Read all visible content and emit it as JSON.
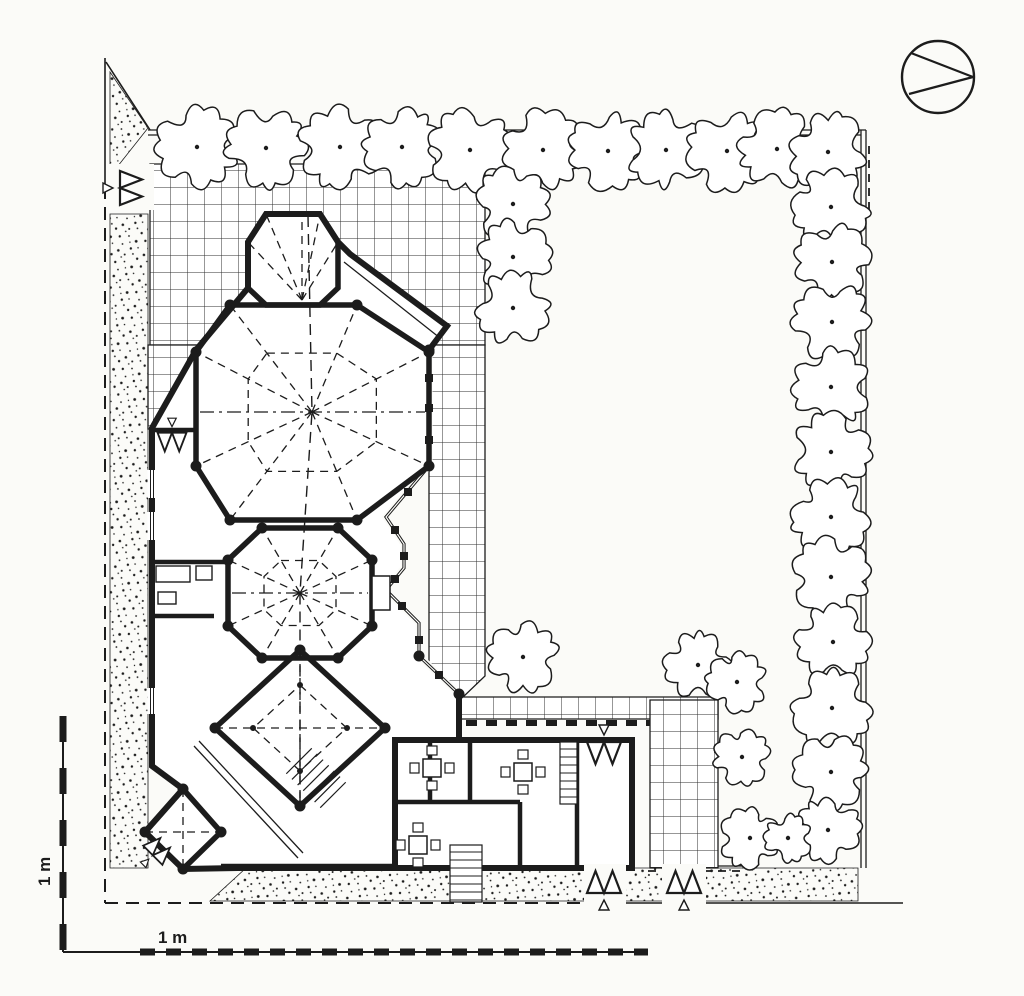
{
  "meta": {
    "drawing_type": "architectural site plan",
    "paper_color": "#fbfbf8",
    "ink_color": "#1c1c1c",
    "grid_line_color": "#2f2f2f"
  },
  "scale_bars": {
    "vertical_label": "1 m",
    "horizontal_label": "1 m",
    "vertical_line": [
      63,
      716,
      63,
      952
    ],
    "horizontal_line": [
      63,
      952,
      648,
      952
    ],
    "horizontal_dashes": [
      140,
      952,
      648,
      952
    ]
  },
  "north_arrow": {
    "cx": 938,
    "cy": 77,
    "r": 36,
    "chords": [
      [
        911,
        53,
        973,
        77
      ],
      [
        909,
        94,
        973,
        77
      ]
    ]
  },
  "boundary": {
    "solid": [
      [
        105,
        58,
        105,
        186
      ],
      [
        585,
        903,
        903,
        903
      ],
      [
        106,
        62,
        150,
        130
      ]
    ],
    "dashed": [
      [
        105,
        186,
        105,
        903
      ],
      [
        105,
        903,
        585,
        903
      ]
    ]
  },
  "fence": {
    "lines": [
      [
        148,
        130,
        866,
        130
      ],
      [
        148,
        135,
        861,
        135
      ],
      [
        861,
        130,
        861,
        868
      ],
      [
        866,
        130,
        866,
        868
      ],
      [
        650,
        866,
        746,
        866
      ]
    ],
    "dashed": [
      [
        869,
        146,
        869,
        214
      ],
      [
        744,
        810,
        744,
        866
      ],
      [
        648,
        871,
        746,
        871
      ]
    ]
  },
  "stipple_areas": [
    [
      [
        110,
        72
      ],
      [
        148,
        128
      ],
      [
        110,
        176
      ]
    ],
    [
      [
        110,
        214
      ],
      [
        148,
        214
      ],
      [
        148,
        868
      ],
      [
        110,
        868
      ]
    ],
    [
      [
        246,
        868
      ],
      [
        858,
        868
      ],
      [
        858,
        901
      ],
      [
        210,
        901
      ]
    ]
  ],
  "paving": {
    "cell": 17,
    "areas": [
      [
        [
          150,
          164
        ],
        [
          485,
          164
        ],
        [
          485,
          345
        ],
        [
          150,
          345
        ]
      ],
      [
        [
          148,
          345
        ],
        [
          205,
          345
        ],
        [
          205,
          429
        ],
        [
          148,
          429
        ]
      ],
      [
        [
          429,
          345
        ],
        [
          485,
          345
        ],
        [
          485,
          676
        ],
        [
          461,
          699
        ],
        [
          429,
          699
        ]
      ],
      [
        [
          461,
          697
        ],
        [
          718,
          697
        ],
        [
          718,
          719
        ],
        [
          461,
          719
        ]
      ],
      [
        [
          650,
          700
        ],
        [
          718,
          700
        ],
        [
          718,
          868
        ],
        [
          650,
          868
        ]
      ]
    ]
  },
  "trees": [
    [
      197,
      147,
      38
    ],
    [
      266,
      148,
      37
    ],
    [
      340,
      147,
      38
    ],
    [
      402,
      147,
      36
    ],
    [
      470,
      150,
      38
    ],
    [
      543,
      150,
      37
    ],
    [
      608,
      151,
      36
    ],
    [
      666,
      150,
      36
    ],
    [
      727,
      151,
      37
    ],
    [
      777,
      149,
      36
    ],
    [
      828,
      152,
      36
    ],
    [
      513,
      204,
      34
    ],
    [
      513,
      257,
      34
    ],
    [
      513,
      308,
      34
    ],
    [
      831,
      207,
      35
    ],
    [
      832,
      262,
      35
    ],
    [
      832,
      322,
      36
    ],
    [
      831,
      387,
      36
    ],
    [
      831,
      452,
      36
    ],
    [
      831,
      517,
      36
    ],
    [
      831,
      577,
      36
    ],
    [
      833,
      642,
      34
    ],
    [
      832,
      708,
      36
    ],
    [
      831,
      772,
      34
    ],
    [
      828,
      830,
      30
    ],
    [
      523,
      657,
      33
    ],
    [
      698,
      665,
      31
    ],
    [
      737,
      682,
      28
    ],
    [
      742,
      757,
      26
    ],
    [
      750,
      838,
      28
    ],
    [
      788,
      838,
      22
    ]
  ],
  "building": {
    "footprint": [
      [
        266,
        214
      ],
      [
        320,
        214
      ],
      [
        338,
        242
      ],
      [
        350,
        254
      ],
      [
        447,
        326
      ],
      [
        429,
        350
      ],
      [
        429,
        466
      ],
      [
        386,
        517
      ],
      [
        404,
        544
      ],
      [
        404,
        568
      ],
      [
        386,
        590
      ],
      [
        419,
        623
      ],
      [
        419,
        656
      ],
      [
        459,
        694
      ],
      [
        459,
        740
      ],
      [
        395,
        740
      ],
      [
        395,
        868
      ],
      [
        238,
        868
      ],
      [
        183,
        869
      ],
      [
        145,
        832
      ],
      [
        183,
        789
      ],
      [
        152,
        766
      ],
      [
        152,
        428
      ],
      [
        196,
        350
      ],
      [
        248,
        288
      ],
      [
        248,
        242
      ]
    ],
    "wing": [
      395,
      740,
      237,
      128
    ],
    "hall": [
      [
        230,
        305
      ],
      [
        357,
        305
      ],
      [
        429,
        352
      ],
      [
        429,
        466
      ],
      [
        357,
        520
      ],
      [
        230,
        520
      ],
      [
        196,
        466
      ],
      [
        196,
        352
      ]
    ],
    "bay": [
      [
        266,
        214
      ],
      [
        320,
        214
      ],
      [
        338,
        242
      ],
      [
        338,
        288
      ],
      [
        320,
        305
      ],
      [
        266,
        305
      ],
      [
        248,
        288
      ],
      [
        248,
        242
      ]
    ],
    "mid": [
      [
        262,
        528
      ],
      [
        338,
        528
      ],
      [
        372,
        560
      ],
      [
        372,
        626
      ],
      [
        338,
        658
      ],
      [
        262,
        658
      ],
      [
        228,
        626
      ],
      [
        228,
        560
      ]
    ],
    "diamond": [
      [
        300,
        650
      ],
      [
        385,
        728
      ],
      [
        300,
        806
      ],
      [
        215,
        728
      ]
    ],
    "sw_bay": [
      [
        183,
        789
      ],
      [
        221,
        832
      ],
      [
        183,
        869
      ],
      [
        145,
        832
      ]
    ],
    "conservatory": [
      [
        429,
        350
      ],
      [
        429,
        466
      ],
      [
        386,
        517
      ],
      [
        404,
        544
      ],
      [
        404,
        568
      ],
      [
        386,
        590
      ],
      [
        419,
        623
      ],
      [
        419,
        656
      ],
      [
        459,
        694
      ]
    ],
    "posts": [
      [
        429,
        378
      ],
      [
        429,
        408
      ],
      [
        429,
        440
      ],
      [
        408,
        492
      ],
      [
        395,
        530
      ],
      [
        404,
        556
      ],
      [
        395,
        579
      ],
      [
        402,
        606
      ],
      [
        419,
        640
      ],
      [
        439,
        675
      ]
    ],
    "partitions": [
      [
        152,
        562,
        228,
        562
      ],
      [
        152,
        616,
        214,
        616
      ],
      [
        196,
        378,
        196,
        430
      ],
      [
        150,
        430,
        196,
        430
      ],
      [
        430,
        740,
        430,
        802
      ],
      [
        470,
        740,
        470,
        802
      ],
      [
        395,
        802,
        520,
        802
      ],
      [
        520,
        802,
        520,
        868
      ],
      [
        577,
        740,
        577,
        868
      ],
      [
        221,
        866,
        395,
        866
      ]
    ],
    "thin_pairs": [
      [
        194,
        746,
        298,
        858
      ],
      [
        199,
        741,
        303,
        853
      ]
    ],
    "thin_lines": [
      [
        344,
        262,
        440,
        338
      ]
    ],
    "pergola_beam": [
      466,
      723,
      650,
      723
    ],
    "windows": [
      [
        152,
        470,
        152,
        498
      ],
      [
        152,
        512,
        152,
        540
      ],
      [
        152,
        688,
        152,
        714
      ]
    ],
    "porch_rect": [
      372,
      576,
      18,
      34
    ],
    "fixtures": [
      [
        156,
        566,
        34,
        16
      ],
      [
        196,
        566,
        16,
        14
      ],
      [
        158,
        592,
        18,
        12
      ]
    ],
    "dots": [
      [
        230,
        305
      ],
      [
        357,
        305
      ],
      [
        429,
        352
      ],
      [
        429,
        466
      ],
      [
        357,
        520
      ],
      [
        230,
        520
      ],
      [
        196,
        466
      ],
      [
        196,
        352
      ],
      [
        262,
        528
      ],
      [
        338,
        528
      ],
      [
        372,
        560
      ],
      [
        372,
        626
      ],
      [
        338,
        658
      ],
      [
        262,
        658
      ],
      [
        228,
        626
      ],
      [
        228,
        560
      ],
      [
        300,
        650
      ],
      [
        385,
        728
      ],
      [
        300,
        806
      ],
      [
        215,
        728
      ],
      [
        183,
        789
      ],
      [
        221,
        832
      ],
      [
        183,
        869
      ],
      [
        145,
        832
      ],
      [
        419,
        656
      ],
      [
        459,
        694
      ],
      [
        429,
        350
      ]
    ],
    "small_dots": [
      [
        300,
        685
      ],
      [
        347,
        728
      ],
      [
        300,
        771
      ],
      [
        253,
        728
      ]
    ],
    "tables": [
      [
        432,
        768
      ],
      [
        523,
        772
      ],
      [
        418,
        845
      ]
    ],
    "stairs": {
      "diagonal": {
        "cx": 316,
        "cy": 778,
        "rot": 45,
        "count": 7,
        "step": 8,
        "len": 36
      },
      "straight": [
        450,
        845,
        32,
        57
      ],
      "wing": [
        560,
        742,
        17,
        62
      ]
    }
  },
  "roof_lines": {
    "hall_center": [
      312,
      412
    ],
    "mid_center": [
      300,
      593
    ],
    "hall_ring_scale": 0.55,
    "mid_ring_scale": 0.5,
    "diamond_center": [
      300,
      728
    ],
    "diamond_ring_scale": 0.55,
    "bay_fan": {
      "origin": [
        302,
        300
      ],
      "targets": [
        [
          266,
          214
        ],
        [
          302,
          214
        ],
        [
          320,
          214
        ],
        [
          248,
          242
        ],
        [
          338,
          242
        ]
      ]
    },
    "axis": [
      [
        308,
        216
      ],
      [
        312,
        412
      ],
      [
        300,
        593
      ],
      [
        300,
        803
      ]
    ],
    "cross": [
      [
        200,
        412,
        425,
        412
      ],
      [
        232,
        593,
        368,
        593
      ]
    ],
    "diamond_diagonals": [
      [
        300,
        650,
        300,
        806
      ],
      [
        215,
        728,
        385,
        728
      ]
    ],
    "sw_diagonals": [
      [
        183,
        789,
        183,
        869
      ],
      [
        145,
        832,
        221,
        832
      ]
    ]
  },
  "entry_arrows": [
    {
      "x": 131,
      "y": 188,
      "rot": -90,
      "s": 1.0
    },
    {
      "x": 172,
      "y": 442,
      "rot": 0,
      "s": 0.85
    },
    {
      "x": 159,
      "y": 849,
      "rot": -135,
      "s": 0.8
    },
    {
      "x": 604,
      "y": 753,
      "rot": 0,
      "s": 1.0
    },
    {
      "x": 604,
      "y": 882,
      "rot": 180,
      "s": 1.0
    },
    {
      "x": 684,
      "y": 882,
      "rot": 180,
      "s": 1.0
    }
  ],
  "arrow_masks": [
    [
      584,
      864,
      42,
      40
    ],
    [
      662,
      864,
      44,
      40
    ],
    [
      106,
      164,
      48,
      46
    ]
  ]
}
